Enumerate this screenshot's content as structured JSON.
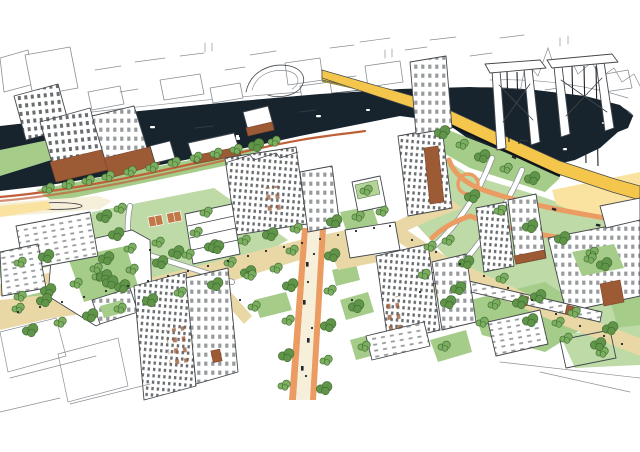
{
  "image": {
    "alt": "Hand-drawn aerial illustration of a riverside urban masterplan: a dark navy river with boats, a sketched industrial far bank, a yellow highway crossing a two-tower truss bridge, white mid-rise and tower buildings with brown podiums, green parks with tree clumps, a tan pedestrian boulevard and an orange-edged main street",
    "type": "architectural masterplan sketch"
  },
  "canvas": {
    "width": 640,
    "height": 452,
    "background": "#ffffff"
  },
  "colors": {
    "ink": "#44484c",
    "ink_soft": "#8a8f94",
    "river": "#17242e",
    "water_line": "#2e3c46",
    "park": "#a5cc89",
    "park_light": "#bedaa6",
    "tree": "#7cae60",
    "tree_dark": "#5f9449",
    "tree_line": "#3e6a31",
    "tan": "#e9d8a6",
    "cream": "#f6efd9",
    "yellow": "#f4c64b",
    "pale_yellow": "#fae3a1",
    "olive": "#9a8f3e",
    "orange": "#eb9c62",
    "red_path": "#c06038",
    "brown": "#9c5a35",
    "brown_dark": "#7d432a",
    "white": "#ffffff",
    "dot": "#23272b",
    "court": "#c27749",
    "roof_green": "#b3d399"
  },
  "scene": {
    "elements": [
      "far-bank-sketch",
      "river",
      "boats",
      "truss-bridge",
      "bridge-deck-road",
      "approach-ramps",
      "riverside-promenade",
      "waterfront-towers",
      "mid-rise-blocks",
      "courtyard-blocks",
      "parks",
      "tennis-courts",
      "pedestrian-boulevard",
      "main-street",
      "trees",
      "people",
      "vehicles"
    ]
  }
}
